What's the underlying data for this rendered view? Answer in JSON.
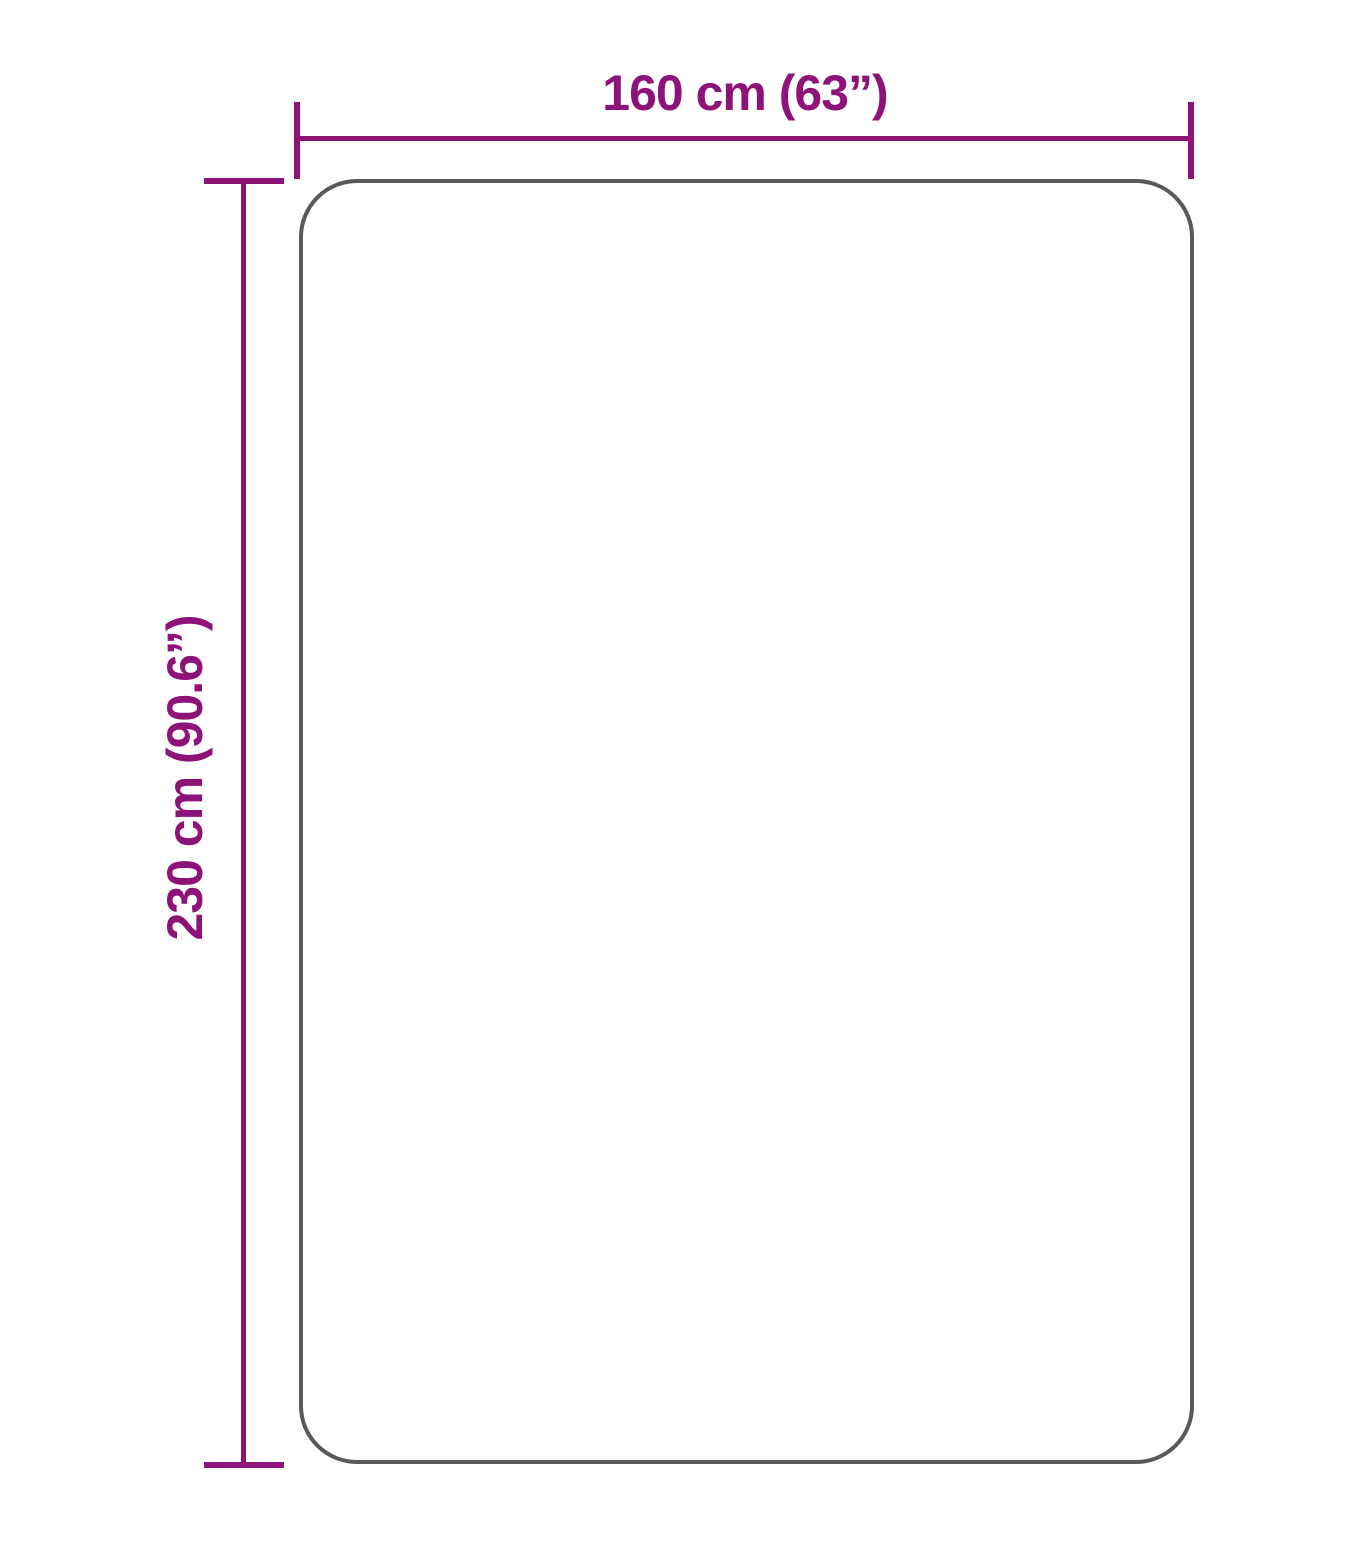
{
  "colors": {
    "accent": "#8D1379",
    "shape_border": "#595959",
    "background": "#ffffff"
  },
  "diagram": {
    "kind": "product-dimension-diagram",
    "shape": "rounded-rectangle-outline",
    "width_label": "160 cm (63”)",
    "height_label": "230 cm (90.6”)",
    "width_value_cm": 160,
    "width_value_inches": 63,
    "height_value_cm": 230,
    "height_value_inches": 90.6
  }
}
